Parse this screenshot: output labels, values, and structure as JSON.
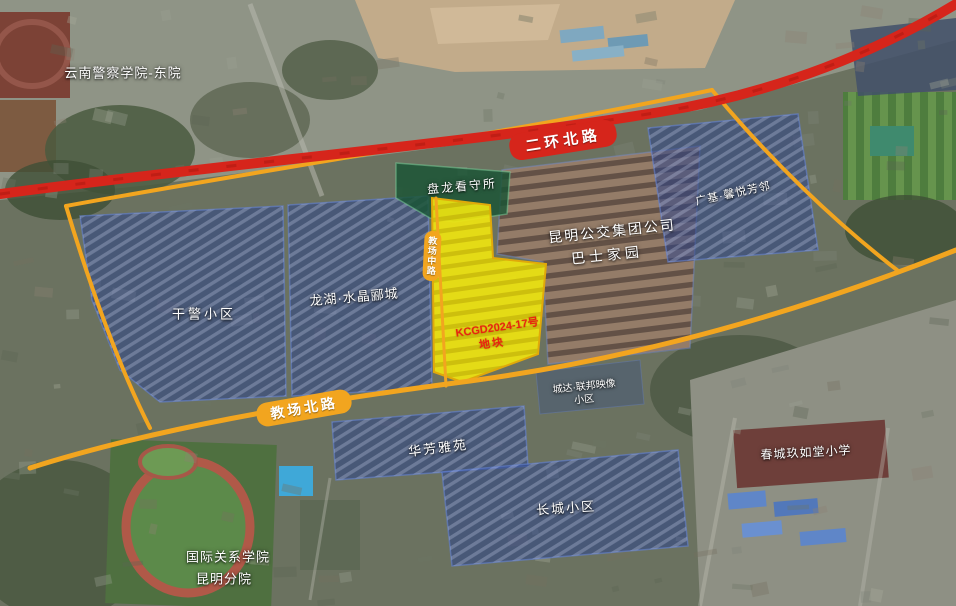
{
  "map": {
    "labels": {
      "police_college": "云南警察学院-东院",
      "ring_road": "二环北路",
      "detention": "盘龙看守所",
      "vertical_road": "教场中路",
      "bus_group_line1": "昆明公交集团公司",
      "bus_group_line2": "巴士家园",
      "guangji": "广基·馨悦芳邻",
      "ganjing": "干警小区",
      "longhu": "龙湖·水晶郦城",
      "parcel_code_line1": "KCGD2024-17号",
      "parcel_code_line2": "地块",
      "chengda_line1": "城达·联邦映像",
      "chengda_line2": "小区",
      "jiaochang_road": "教场北路",
      "huafang": "华芳雅苑",
      "changcheng": "长城小区",
      "intl_college_line1": "国际关系学院",
      "intl_college_line2": "昆明分院",
      "school": "春城玖如堂小学"
    },
    "colors": {
      "highway_red": "#d6251b",
      "boundary_orange": "#f2a51f",
      "parcel_yellow": "#f2e70e",
      "parcel_text_red": "#e8250f",
      "overlay_blue": "#2b448a",
      "overlay_green": "#185434",
      "bus_area_brown": "#8f6f4f",
      "label_text": "#ffffff"
    }
  }
}
